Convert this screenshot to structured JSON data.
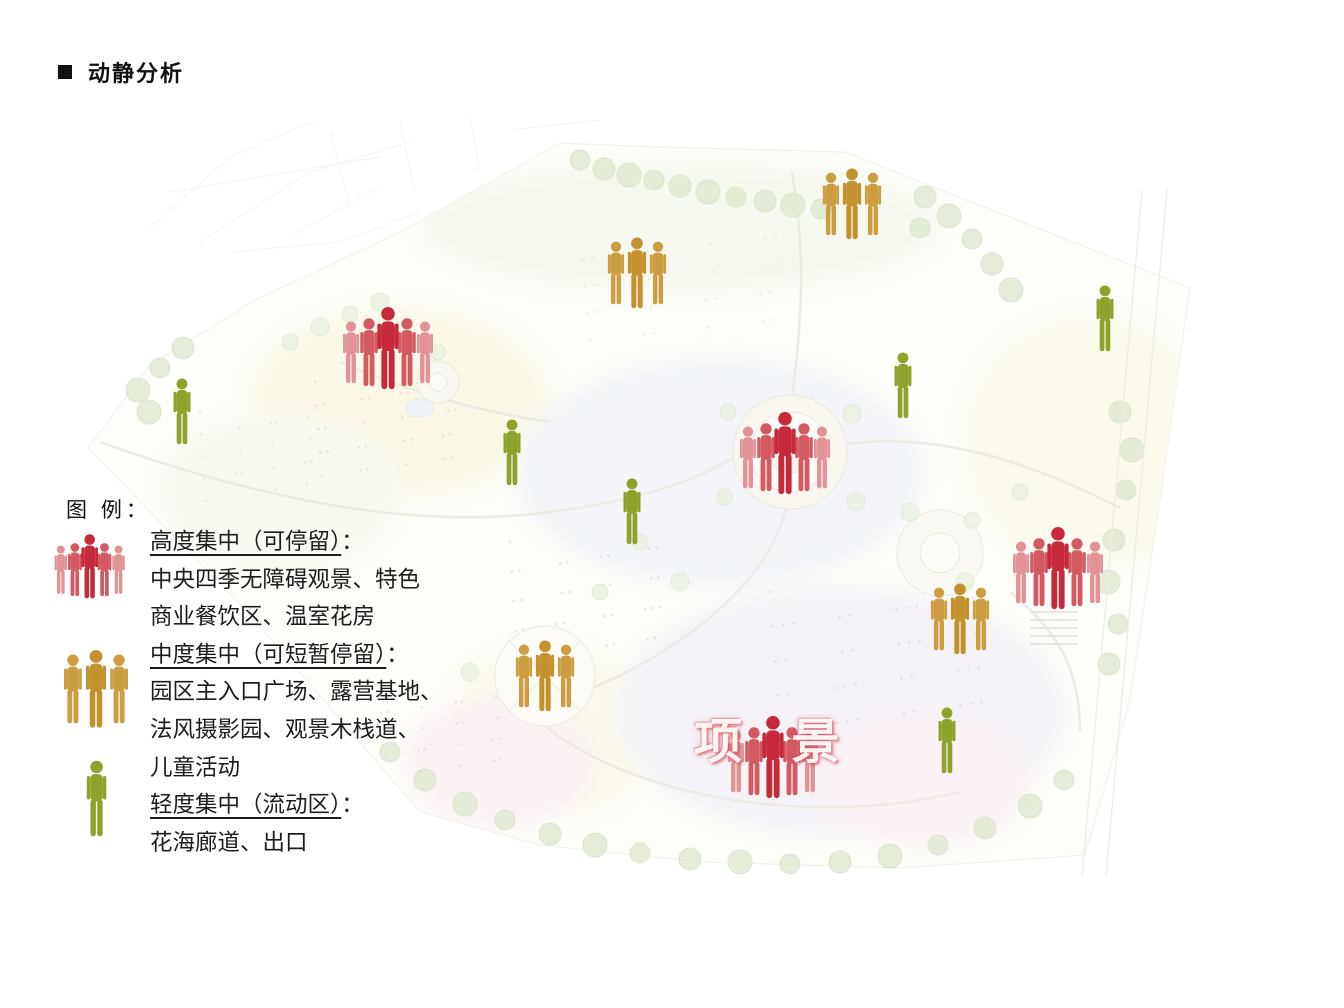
{
  "title": {
    "bullet_icon": "black-square",
    "text": "动静分析"
  },
  "legend": {
    "heading": "图 例：",
    "entries": [
      {
        "icon": "red-group",
        "term": "高度集中（可停留）",
        "colon": "：",
        "desc": [
          "中央四季无障碍观景、特色",
          "商业餐饮区、温室花房"
        ]
      },
      {
        "icon": "orange-group",
        "term": "中度集中（可短暂停留）",
        "colon": "：",
        "desc": [
          "园区主入口广场、露营基地、",
          "法风摄影园、观景木栈道、",
          "儿童活动"
        ]
      },
      {
        "icon": "green-single",
        "term": "轻度集中（流动区）",
        "colon": "：",
        "desc": [
          "花海廊道、出口"
        ]
      }
    ]
  },
  "map": {
    "watermark": "项 景",
    "road_label": "318",
    "markers": [
      {
        "type": "red-group",
        "x": 388,
        "y": 347
      },
      {
        "type": "red-group",
        "x": 785,
        "y": 452
      },
      {
        "type": "red-group",
        "x": 1058,
        "y": 567
      },
      {
        "type": "red-group",
        "x": 773,
        "y": 756
      },
      {
        "type": "orange-group",
        "x": 852,
        "y": 202
      },
      {
        "type": "orange-group",
        "x": 637,
        "y": 271
      },
      {
        "type": "orange-group",
        "x": 545,
        "y": 674
      },
      {
        "type": "orange-group",
        "x": 960,
        "y": 617
      },
      {
        "type": "green-single",
        "x": 182,
        "y": 411
      },
      {
        "type": "green-single",
        "x": 512,
        "y": 452
      },
      {
        "type": "green-single",
        "x": 632,
        "y": 511
      },
      {
        "type": "green-single",
        "x": 903,
        "y": 385
      },
      {
        "type": "green-single",
        "x": 1105,
        "y": 318
      },
      {
        "type": "green-single",
        "x": 947,
        "y": 740
      }
    ]
  },
  "colors": {
    "red_dark": "#c5293a",
    "red_mid": "#d45a62",
    "red_light": "#e29397",
    "orange_dark": "#c3922e",
    "orange_light": "#cc9e41",
    "green": "#8ea32c"
  }
}
